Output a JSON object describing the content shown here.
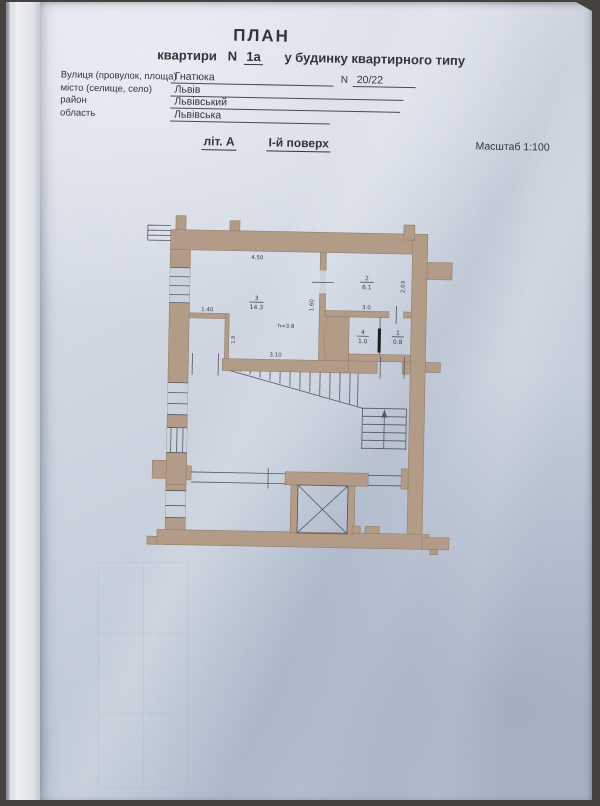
{
  "photo": {
    "background_color": "#45423e",
    "paper_color": "#ccd3df",
    "wall_fill_color": "#b29c88",
    "plan_line_color": "#565862"
  },
  "header": {
    "title": "ПЛАН",
    "subtitle": {
      "part1": "квартири",
      "n_label": "N",
      "apt_number": "1а",
      "part2": "у будинку квартирного типу"
    },
    "fields": [
      {
        "label": "Вулиця (провулок, площа)",
        "value": "Гнатюка",
        "n_label": "N",
        "n_value": "20/22"
      },
      {
        "label": "місто (селище, село)",
        "value": "Львів"
      },
      {
        "label": "район",
        "value": "Львівський"
      },
      {
        "label": "область",
        "value": "Львівська"
      }
    ],
    "liter": "літ. А",
    "floor": "І-й поверх",
    "scale": "Масштаб 1:100"
  },
  "plan": {
    "rooms": [
      {
        "number": "3",
        "area": "14.3"
      },
      {
        "number": "2",
        "area": "6.1"
      },
      {
        "number": "4",
        "area": "1.0"
      },
      {
        "number": "1",
        "area": "0.8"
      }
    ],
    "height_note": "h=3.8",
    "dimensions": {
      "room3_top_width": "4.50",
      "room3_bottom_width": "3.10",
      "room3_right_opening": "1.60",
      "closet_width": "1.40",
      "closet_depth": "1.9",
      "room2_width": "3.0",
      "room2_depth": "2.03"
    }
  }
}
